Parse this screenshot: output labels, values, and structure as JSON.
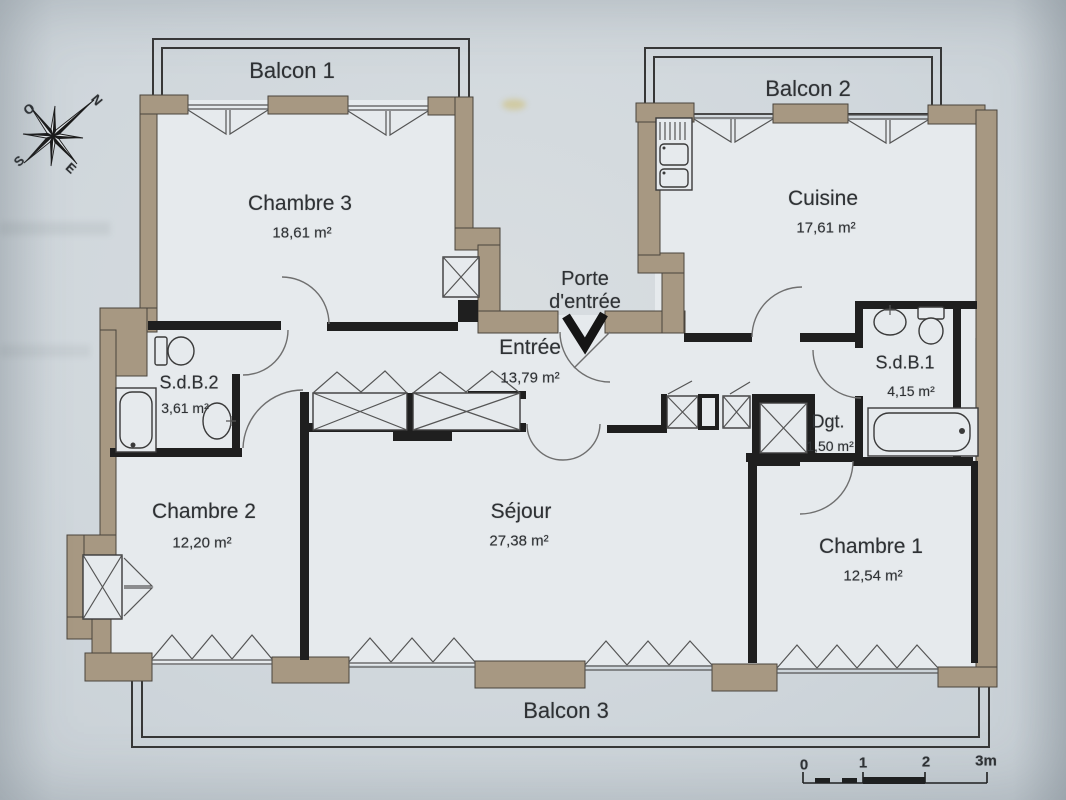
{
  "plan": {
    "balconies": [
      {
        "name": "Balcon 1"
      },
      {
        "name": "Balcon 2"
      },
      {
        "name": "Balcon 3"
      }
    ],
    "rooms": [
      {
        "name": "Chambre 3",
        "area": "18,61 m²"
      },
      {
        "name": "Cuisine",
        "area": "17,61 m²"
      },
      {
        "name": "Entrée",
        "area": "13,79 m²"
      },
      {
        "name": "S.d.B.2",
        "area": "3,61 m²"
      },
      {
        "name": "S.d.B.1",
        "area": "4,15 m²"
      },
      {
        "name": "Dgt.",
        "area": "1,50 m²"
      },
      {
        "name": "Chambre 2",
        "area": "12,20 m²"
      },
      {
        "name": "Séjour",
        "area": "27,38 m²"
      },
      {
        "name": "Chambre 1",
        "area": "12,54 m²"
      }
    ],
    "entrance_door_label": "Porte d'entrée",
    "compass": {
      "n": "N",
      "o": "O",
      "s": "S",
      "e": "E"
    },
    "scale_bar": {
      "ticks": [
        "0",
        "1",
        "2",
        "3m"
      ]
    }
  },
  "colors": {
    "background": "#d0d7dc",
    "floor": "#e6eaed",
    "exterior_wall": "#a79882",
    "interior_wall": "#1f1f1f",
    "outline": "#4a443c"
  }
}
